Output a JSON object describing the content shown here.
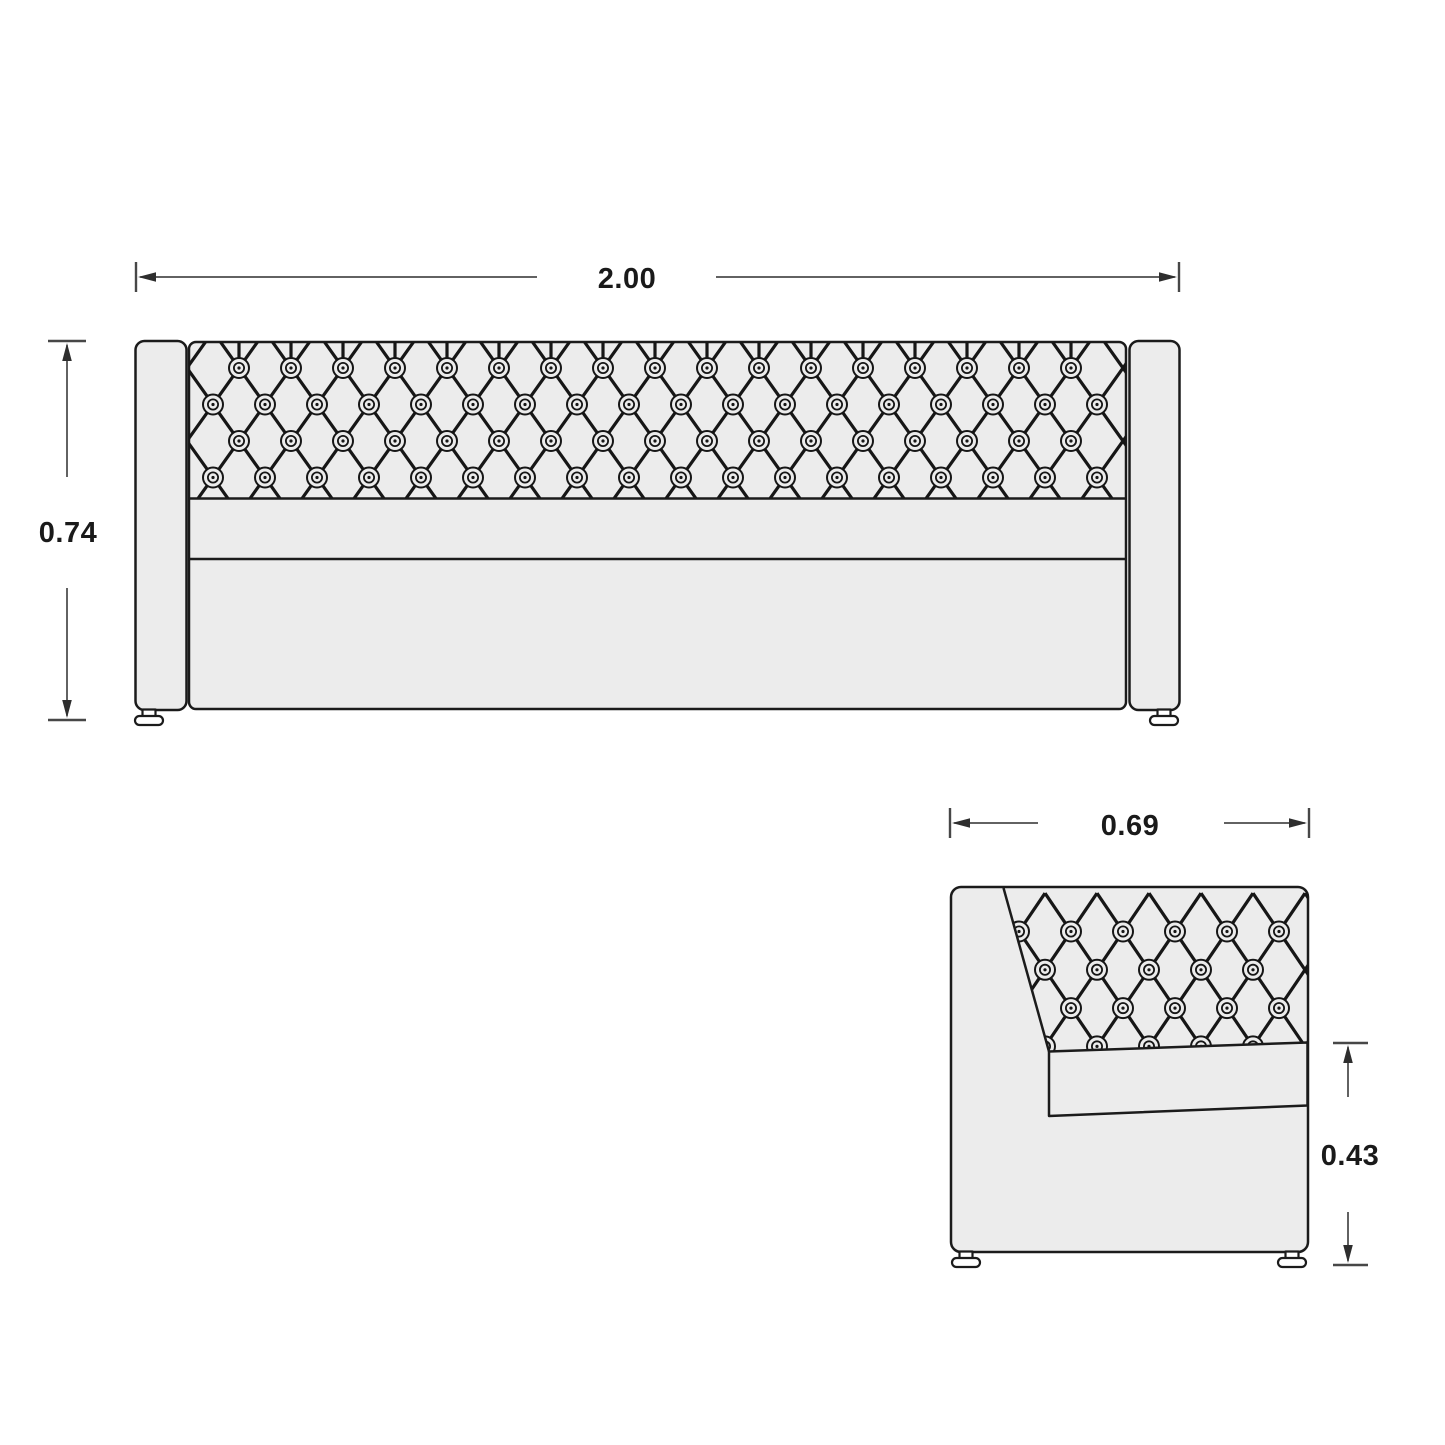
{
  "page": {
    "background": "#ffffff",
    "kind": "furniture-technical-drawing"
  },
  "palette": {
    "background": "#ffffff",
    "panel_fill": "#ececec",
    "outline": "#1b1b1b",
    "lattice": "#161616",
    "dimension": "#2e2e2e",
    "tick": "#474747",
    "text": "#1a1a1a",
    "foot_fill": "#ffffff"
  },
  "dimensions": {
    "front_width": {
      "label": "2.00"
    },
    "front_height": {
      "label": "0.74"
    },
    "side_depth": {
      "label": "0.69"
    },
    "side_seat_height": {
      "label": "0.43"
    }
  },
  "views": {
    "front": {
      "name": "sofa-front-elevation"
    },
    "side": {
      "name": "sofa-side-elevation"
    }
  },
  "tufting": {
    "button": {
      "outer_r": 10,
      "inner_r": 5.1,
      "dot_r": 1.6
    },
    "front": {
      "lattice": {
        "ax": 239,
        "ay": 368,
        "dxu": 26,
        "dyu": 36.5,
        "pitch": 52,
        "kmin": -4,
        "kmax": 18,
        "tTop": -0.75,
        "tBot": 3.85
      },
      "stems": {
        "x0": 239,
        "n": 17,
        "pitch": 52,
        "y1": 342,
        "y2": 369
      },
      "rows": [
        {
          "y": 368,
          "x0": 239,
          "n": 17
        },
        {
          "y": 404.5,
          "x0": 213,
          "n": 18
        },
        {
          "y": 441,
          "x0": 239,
          "n": 17
        },
        {
          "y": 477.5,
          "x0": 213,
          "n": 18
        }
      ]
    },
    "side": {
      "lattice": {
        "ax": 1019,
        "ay": 931.5,
        "dxu": 26,
        "dyu": 38.3,
        "pitch": 52,
        "kmin": -3,
        "kmax": 7,
        "tTop": -1.0,
        "tBot": 3.6
      },
      "rows": [
        {
          "y": 931.5,
          "x0": 1019,
          "n": 6
        },
        {
          "y": 969.8,
          "x0": 1045,
          "n": 5
        },
        {
          "y": 1008.1,
          "x0": 1019,
          "n": 6
        },
        {
          "y": 1046.4,
          "x0": 1045,
          "n": 5
        }
      ]
    }
  }
}
